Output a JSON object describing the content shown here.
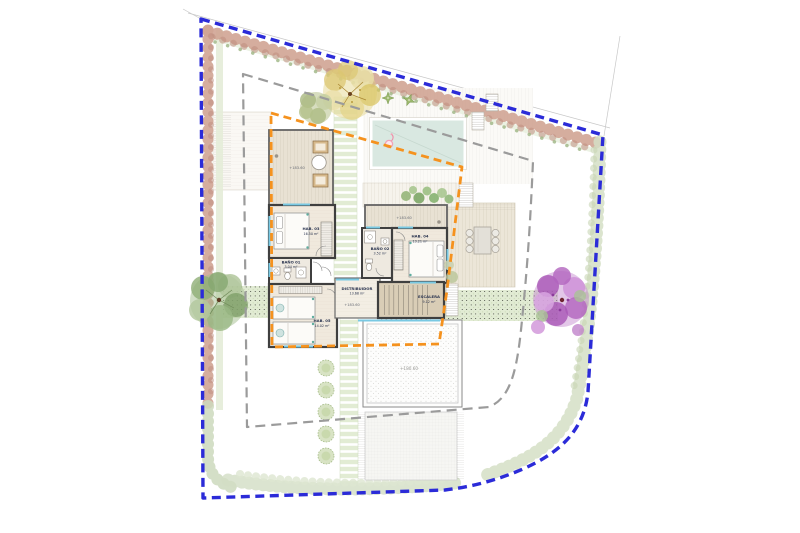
{
  "plan": {
    "title": "villa-site-plan",
    "rooms": {
      "hab03": {
        "name": "HAB. 03",
        "area": "16.50 m²"
      },
      "hab04": {
        "name": "HAB. 04",
        "area": "13.21 m²"
      },
      "hab05": {
        "name": "HAB. 05",
        "area": "14.02 m²"
      },
      "bano01": {
        "name": "BAÑO 01",
        "area": "3.04 m²"
      },
      "bano02": {
        "name": "BAÑO 02",
        "area": "3.52 m²"
      },
      "distribuidor": {
        "name": "DISTRIBUIDOR",
        "area": "13.68 m²",
        "level": "+183.60"
      },
      "escalera": {
        "name": "ESCALERA",
        "area": "9.12 m²"
      }
    },
    "levels": {
      "terrace_left": "+183.60",
      "terrace_right": "+183.60",
      "courtyard": "+180.60"
    },
    "colors": {
      "site_boundary": "#2b2bd8",
      "setback": "#9b9b9b",
      "buildable_envelope": "#f5921e",
      "pool_water": "#d9e8e1",
      "glazing": "#79c9e3"
    }
  }
}
